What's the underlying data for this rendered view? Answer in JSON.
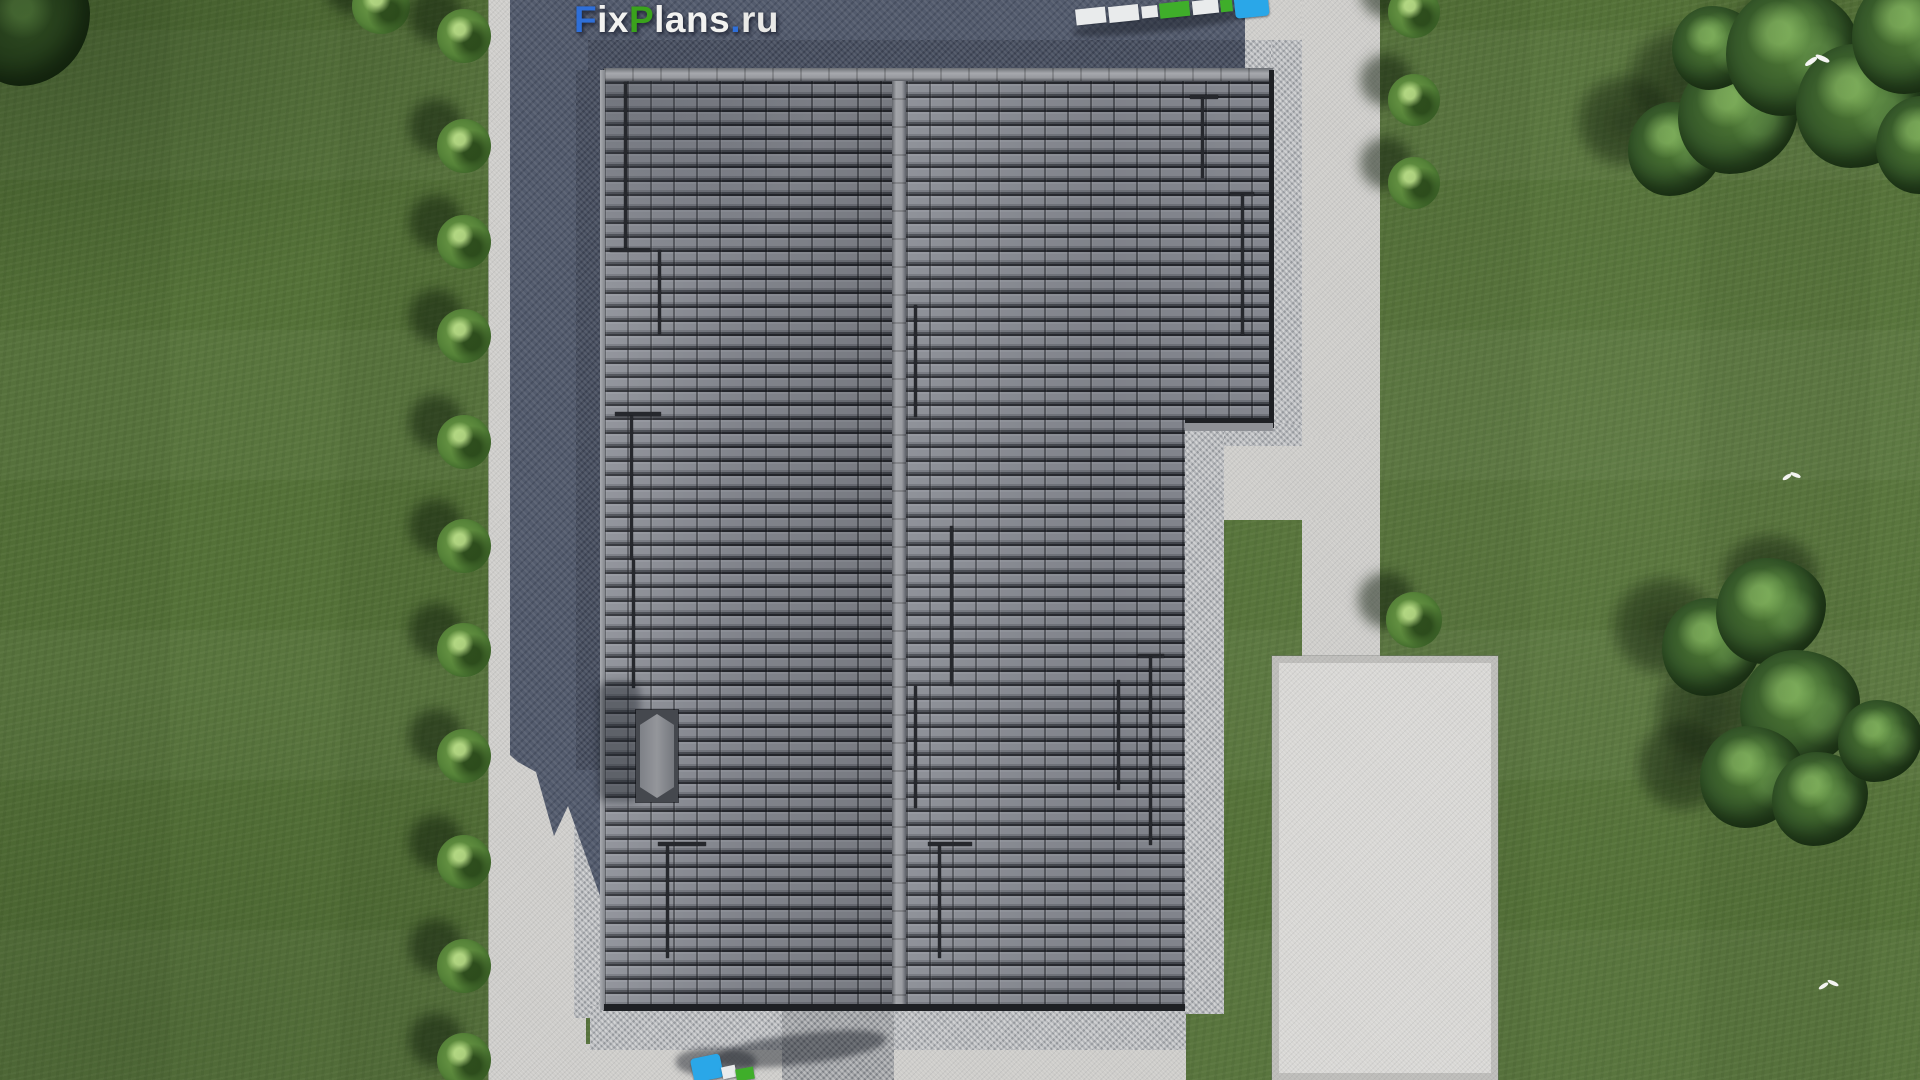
{
  "watermark": {
    "text": "FixPlans.ru",
    "segments": [
      {
        "text": "F",
        "color": "#2f6fd8"
      },
      {
        "text": "ix",
        "color": "#f2f2f0"
      },
      {
        "text": "P",
        "color": "#3aa31c"
      },
      {
        "text": "lans",
        "color": "#f2f2f0"
      },
      {
        "text": ".",
        "color": "#2f6fd8"
      },
      {
        "text": "ru",
        "color": "#e9e9e7"
      }
    ]
  },
  "colors": {
    "grass": "#547138",
    "tree-dark": "#24401b",
    "tree-light": "#517c36",
    "bush-green": "#74a24c",
    "concrete": "#cecdca",
    "concrete-bright": "#d8d7d4",
    "gravel": "#b3b5b8",
    "shadow-paving": "#535b6d",
    "roof-tile": "#84878e",
    "roof-gap": "#24262c",
    "roof-ridge": "#9b9da2",
    "roof-bar": "#26282d",
    "chimney-cap": "#94969b",
    "truck-cab-blue": "#2aa7e8",
    "cargo-green": "#3fae2a",
    "cargo-white": "#e9ebec",
    "bird-white": "#f4f4f2"
  }
}
